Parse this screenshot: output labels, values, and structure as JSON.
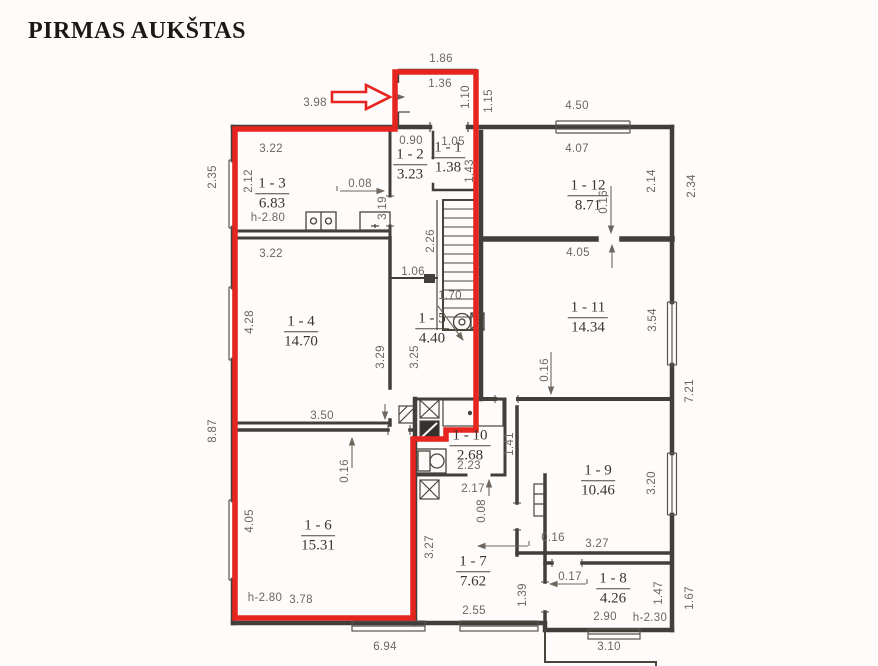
{
  "title": "PIRMAS AUKŠTAS",
  "rooms": {
    "r1": {
      "id": "1 - 1",
      "area": "1.38"
    },
    "r2": {
      "id": "1 - 2",
      "area": "3.23"
    },
    "r3": {
      "id": "1 - 3",
      "area": "6.83"
    },
    "r4": {
      "id": "1 - 4",
      "area": "14.70"
    },
    "r5": {
      "id": "1 - 5",
      "area": "4.40"
    },
    "r6": {
      "id": "1 - 6",
      "area": "15.31"
    },
    "r7": {
      "id": "1 - 7",
      "area": "7.62"
    },
    "r8": {
      "id": "1 - 8",
      "area": "4.26"
    },
    "r9": {
      "id": "1 - 9",
      "area": "10.46"
    },
    "r10": {
      "id": "1 - 10",
      "area": "2.68"
    },
    "r11": {
      "id": "1 - 11",
      "area": "14.34"
    },
    "r12": {
      "id": "1 - 12",
      "area": "8.71"
    }
  },
  "dims": {
    "entry_top": "1.86",
    "entry_width": "1.36",
    "entry_depth": "1.10",
    "entry_side": "1.15",
    "top_left_span": "3.98",
    "top_right_span": "4.50",
    "r2_top": "0.90",
    "r1_top": "1.05",
    "r1_right": "1.43",
    "r3_top": "3.22",
    "r3_left": "2.12",
    "r3_wall": "0.08",
    "r3_height": "h-2.80",
    "r12_top": "4.07",
    "r12_right": "2.14",
    "r12_outer_right": "2.34",
    "r12_wall": "0.16",
    "r2_left": "3.19",
    "r2_mid": "2.26",
    "r2_bottom": "1.06",
    "outer_left_top": "2.35",
    "outer_left_bottom": "8.87",
    "r4_top": "3.22",
    "r4_left": "4.28",
    "r4_right": "3.29",
    "r4_bottom": "3.50",
    "r5_left": "3.25",
    "stairs_run": "1.70",
    "r11_top": "4.05",
    "r11_right": "3.54",
    "r11_wall": "0.16",
    "outer_right_mid": "7.21",
    "r10_width": "2.23",
    "r10_right": "1.41",
    "r7_top": "2.17",
    "r7_wall": "0.08",
    "r7_left": "3.27",
    "r7_door": "1.39",
    "r7_bottom": "2.55",
    "r9_right": "3.20",
    "r9_wall": "0.16",
    "r9_bottom": "3.27",
    "r6_wall": "0.16",
    "r6_left": "4.05",
    "r6_bottom": "3.78",
    "r6_height": "h-2.80",
    "r8_wall": "0.17",
    "r8_right": "1.47",
    "r8_outer_right": "1.67",
    "r8_bottom": "2.90",
    "r8_height": "h-2.30",
    "bottom_left_span": "6.94",
    "bottom_right_span": "3.10"
  },
  "colors": {
    "highlight": "#e62420",
    "wall": "#423e3a",
    "dim_text": "#6e665f",
    "room_text": "#3a342e",
    "paper": "#fdfcfa"
  }
}
